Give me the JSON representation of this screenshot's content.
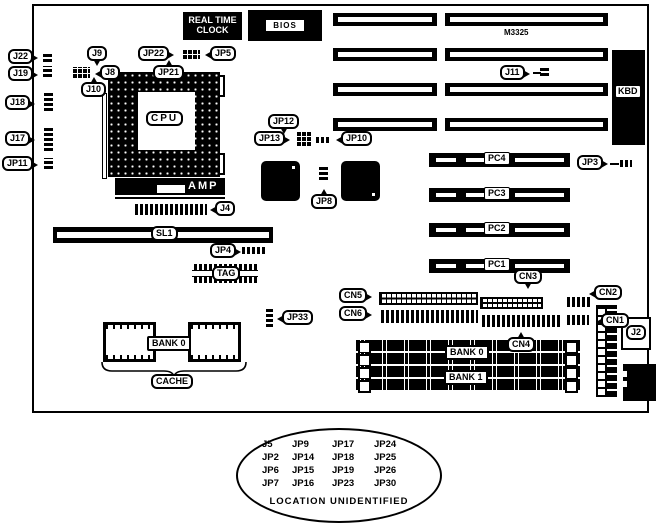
{
  "diagram": {
    "type": "motherboard-layout",
    "board_marking": "M3325",
    "rtc": {
      "line1": "REAL TIME",
      "line2": "CLOCK"
    },
    "bios_label": "BIOS",
    "amp_label": "AMP",
    "labels": [
      {
        "id": "j22",
        "text": "J22"
      },
      {
        "id": "j19",
        "text": "J19"
      },
      {
        "id": "j18",
        "text": "J18"
      },
      {
        "id": "j17",
        "text": "J17"
      },
      {
        "id": "jp11",
        "text": "JP11"
      },
      {
        "id": "j9",
        "text": "J9"
      },
      {
        "id": "j8",
        "text": "J8"
      },
      {
        "id": "j10",
        "text": "J10"
      },
      {
        "id": "jp22",
        "text": "JP22"
      },
      {
        "id": "jp5",
        "text": "JP5"
      },
      {
        "id": "jp21",
        "text": "JP21"
      },
      {
        "id": "cpu",
        "text": "CPU"
      },
      {
        "id": "jp12",
        "text": "JP12"
      },
      {
        "id": "jp13",
        "text": "JP13"
      },
      {
        "id": "jp10",
        "text": "JP10"
      },
      {
        "id": "jp8",
        "text": "JP8"
      },
      {
        "id": "j4",
        "text": "J4"
      },
      {
        "id": "sl1",
        "text": "SL1"
      },
      {
        "id": "jp4",
        "text": "JP4"
      },
      {
        "id": "tag",
        "text": "TAG"
      },
      {
        "id": "jp33",
        "text": "JP33"
      },
      {
        "id": "bank0-cache",
        "text": "BANK 0"
      },
      {
        "id": "cache",
        "text": "CACHE"
      },
      {
        "id": "j11",
        "text": "J11"
      },
      {
        "id": "kbd",
        "text": "KBD"
      },
      {
        "id": "jp3",
        "text": "JP3"
      },
      {
        "id": "cn5",
        "text": "CN5"
      },
      {
        "id": "cn6",
        "text": "CN6"
      },
      {
        "id": "cn3",
        "text": "CN3"
      },
      {
        "id": "cn4",
        "text": "CN4"
      },
      {
        "id": "cn2",
        "text": "CN2"
      },
      {
        "id": "cn1",
        "text": "CN1"
      },
      {
        "id": "j2",
        "text": "J2"
      },
      {
        "id": "bank0-dram",
        "text": "BANK 0"
      },
      {
        "id": "bank1-dram",
        "text": "BANK 1"
      },
      {
        "id": "pc4",
        "text": "PC4"
      },
      {
        "id": "pc3",
        "text": "PC3"
      },
      {
        "id": "pc2",
        "text": "PC2"
      },
      {
        "id": "pc1",
        "text": "PC1"
      }
    ],
    "unidentified": {
      "rows": [
        [
          "J5",
          "JP9",
          "JP17",
          "JP24"
        ],
        [
          "JP2",
          "JP14",
          "JP18",
          "JP25"
        ],
        [
          "JP6",
          "JP15",
          "JP19",
          "JP26"
        ],
        [
          "JP7",
          "JP16",
          "JP23",
          "JP30"
        ]
      ],
      "caption": "LOCATION UNIDENTIFIED"
    }
  }
}
